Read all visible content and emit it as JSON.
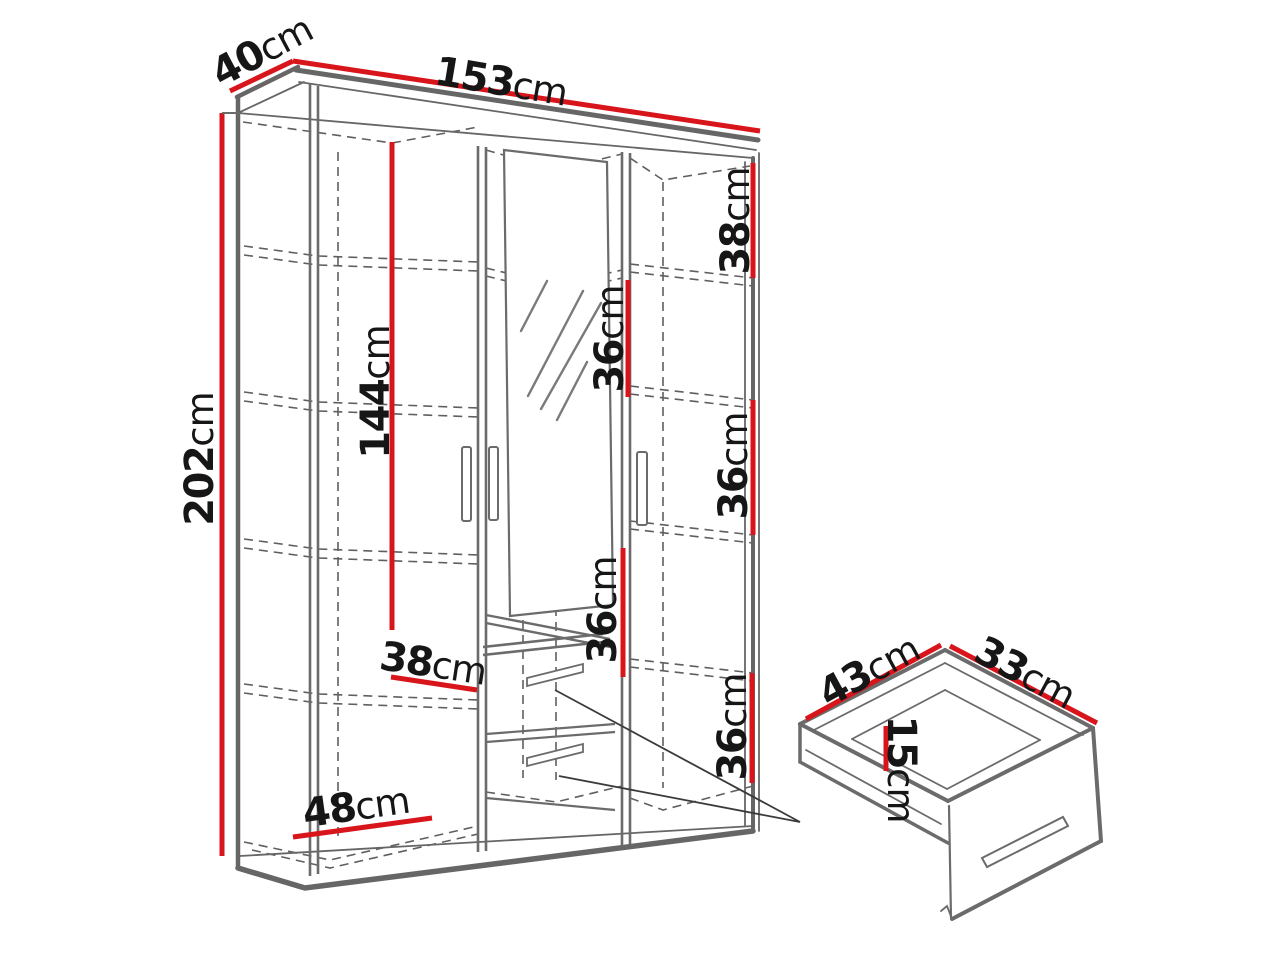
{
  "diagram": {
    "type": "furniture-dimension-diagram",
    "subject": "three-door wardrobe with mirror and two drawers, plus open drawer detail",
    "colors": {
      "dimension_red": "#d9151c",
      "line_gray": "#5a5a5a",
      "background": "#ffffff",
      "label_black": "#161616"
    }
  },
  "dims": {
    "depth": {
      "value": "40",
      "unit": "cm"
    },
    "width": {
      "value": "153",
      "unit": "cm"
    },
    "height": {
      "value": "202",
      "unit": "cm"
    },
    "right_top_section": {
      "value": "38",
      "unit": "cm"
    },
    "left_door_inner_height": {
      "value": "144",
      "unit": "cm"
    },
    "mirror_section_upper": {
      "value": "36",
      "unit": "cm"
    },
    "right_middle_section": {
      "value": "36",
      "unit": "cm"
    },
    "mirror_section_lower": {
      "value": "36",
      "unit": "cm"
    },
    "right_bottom_section": {
      "value": "36",
      "unit": "cm"
    },
    "left_shelf_width": {
      "value": "38",
      "unit": "cm"
    },
    "left_bottom_width": {
      "value": "48",
      "unit": "cm"
    }
  },
  "drawer_dims": {
    "depth": {
      "value": "43",
      "unit": "cm"
    },
    "width": {
      "value": "33",
      "unit": "cm"
    },
    "height": {
      "value": "15",
      "unit": "cm"
    }
  }
}
